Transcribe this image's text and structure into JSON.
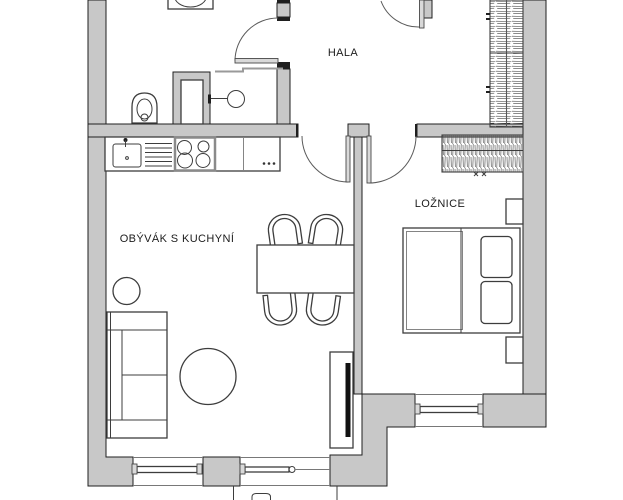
{
  "plan": {
    "type": "apartment-floor-plan",
    "rooms": {
      "hala": {
        "label": "HALA"
      },
      "loznice": {
        "label": "LOŽNICE"
      },
      "obyvak_s_kuchyni": {
        "label": "OBÝVÁK S KUCHYNÍ"
      }
    }
  },
  "colors": {
    "background": "#ffffff",
    "wall_fill": "#c8c8c8",
    "wall_line": "#1f1f1f",
    "furniture_line": "#3d3d3d",
    "text": "#1c1c1c",
    "tv": "#111111"
  }
}
